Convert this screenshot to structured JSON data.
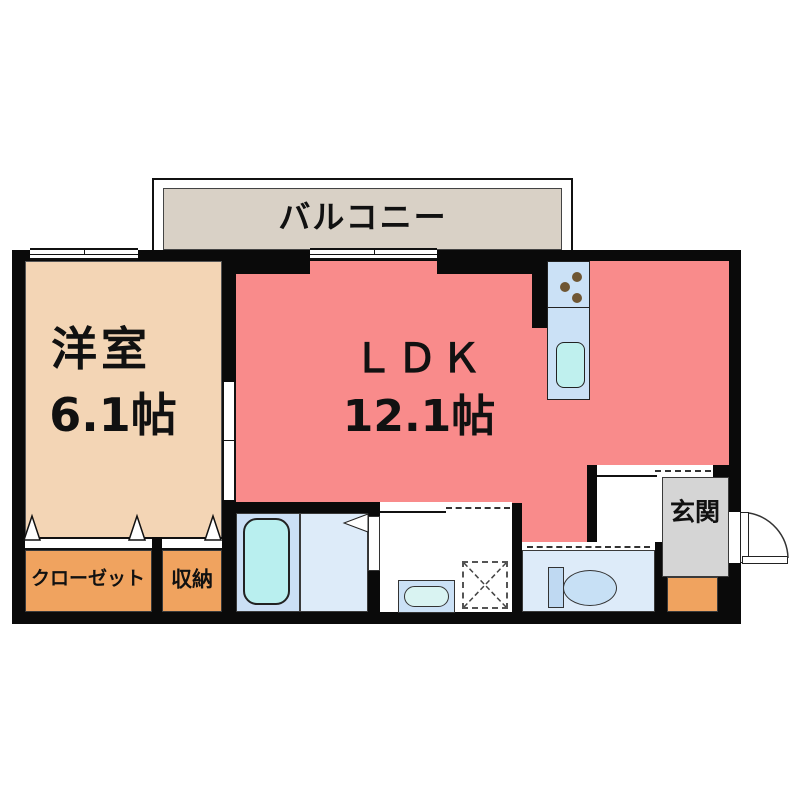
{
  "rooms": {
    "balcony": {
      "label": "バルコニー"
    },
    "western_room": {
      "label": "洋室",
      "size": "6.1帖"
    },
    "ldk": {
      "label": "ＬＤＫ",
      "size": "12.1帖"
    },
    "closet": {
      "label": "クローゼット"
    },
    "storage": {
      "label": "収納"
    },
    "entrance": {
      "label": "玄関"
    }
  },
  "colors": {
    "wall": "#0a0a0a",
    "ldk_pink": "#F98B8B",
    "western_peach": "#F3D5B5",
    "closet_orange": "#F0A35F",
    "balcony_beige": "#D9D1C6",
    "entrance_gray": "#D5D5D5",
    "entrance_step_orange": "#F0A35F",
    "fixture_blue": "#CBE1F6",
    "floor_blue_light": "#DDEBF9",
    "bath_floor_blue": "#CBDFF5",
    "tank_blue": "#BFD9F2",
    "bowl_blue": "#C7E0F5",
    "tub_cyan": "#B9EFEF",
    "sink_cyan": "#BFF0EE",
    "basin_cyan": "#D9F3F2",
    "burner_brown": "#6F5633",
    "paper_white": "#ffffff"
  }
}
